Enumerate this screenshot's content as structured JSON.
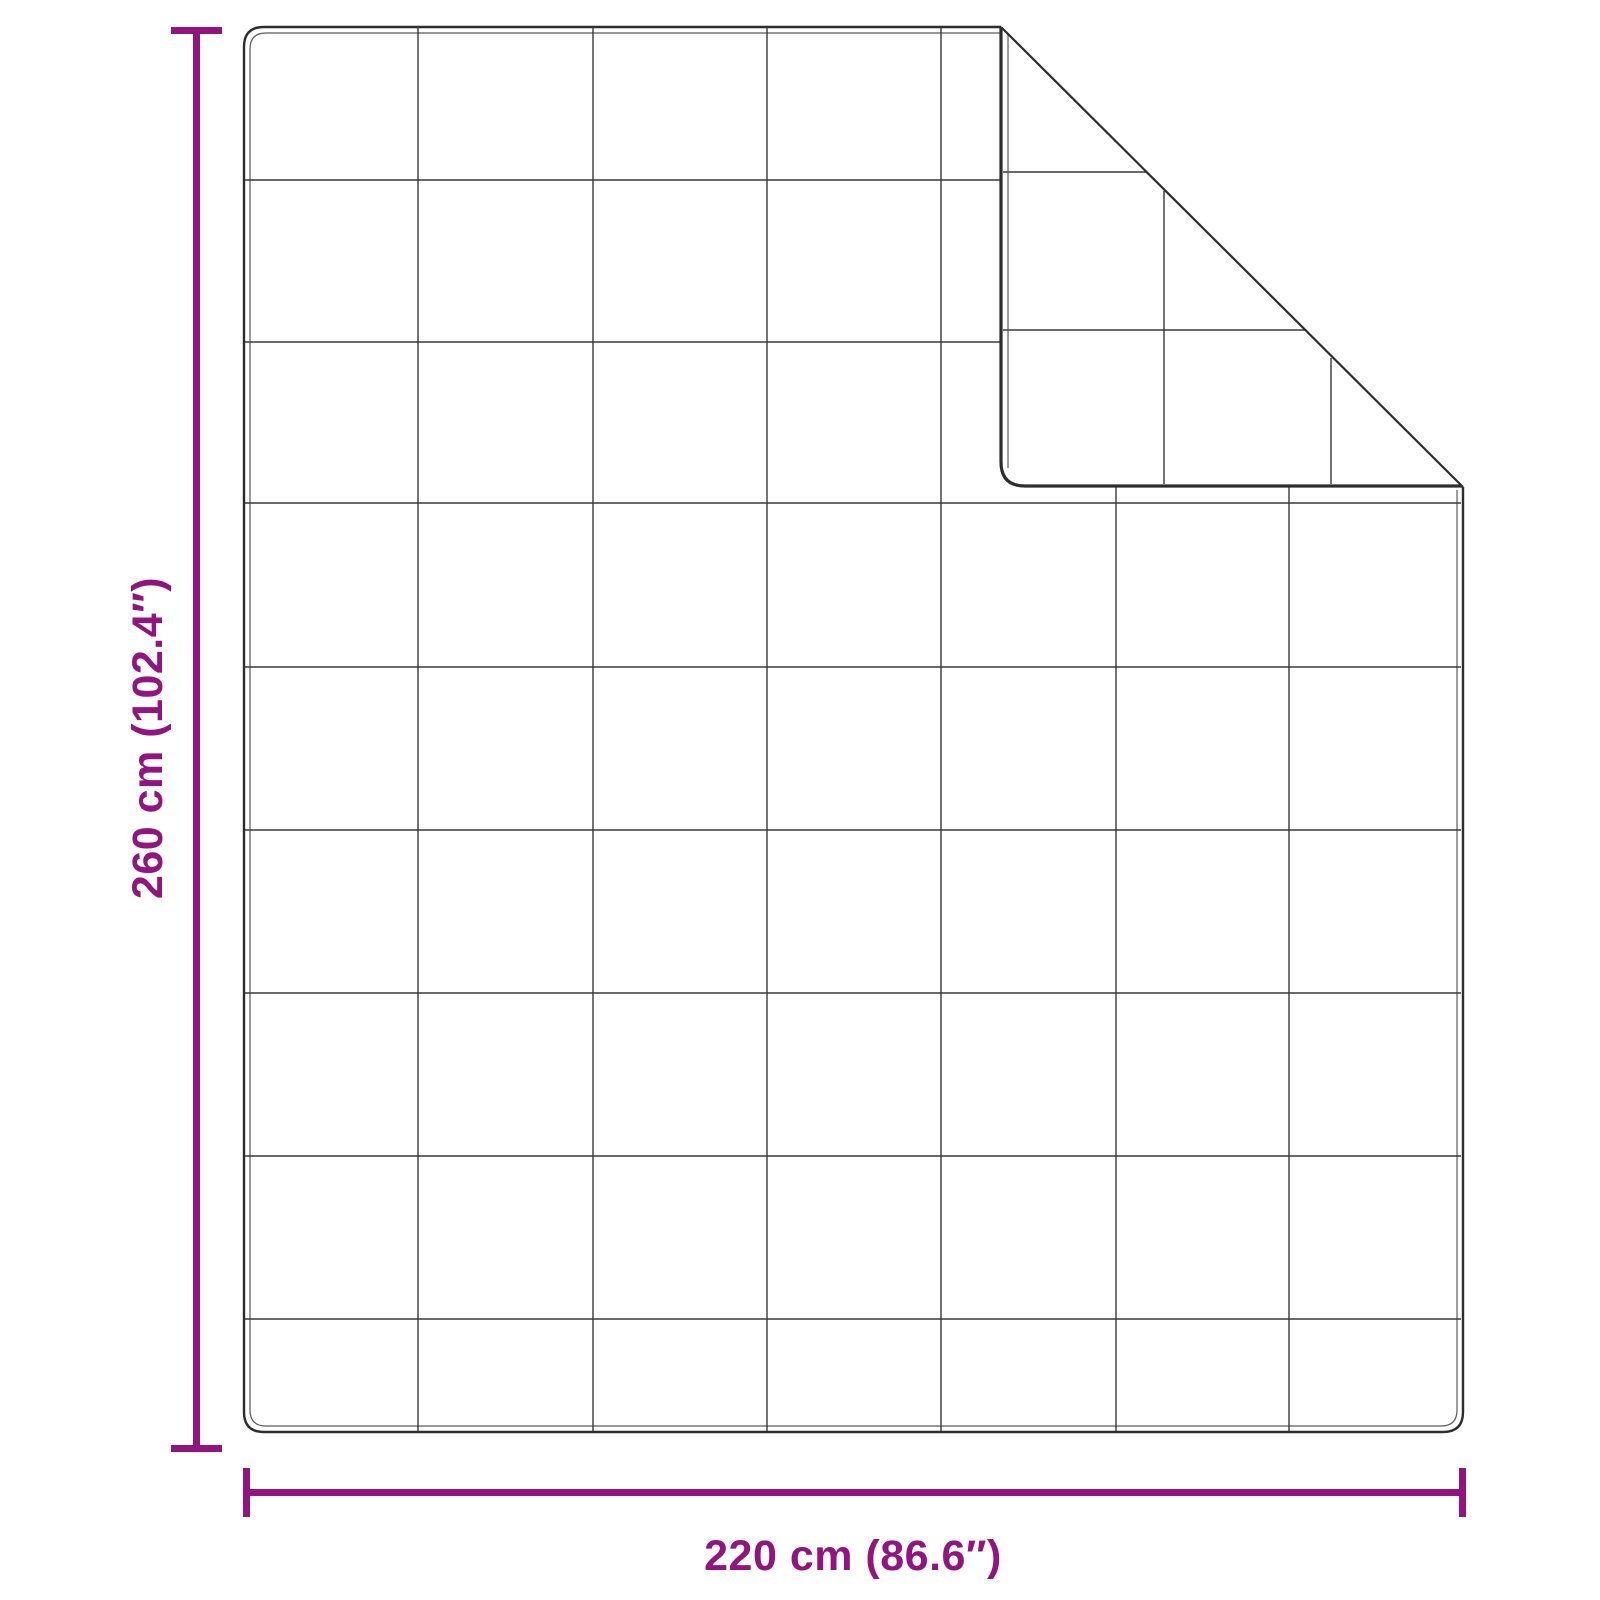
{
  "diagram": {
    "kind": "product-dimension-diagram",
    "subject": "quilted blanket with folded top-right corner"
  },
  "labels": {
    "height": "260 cm (102.4″)",
    "width": "220 cm (86.6″)"
  },
  "colors": {
    "dimension": "#92157F",
    "outline": "#2d2d2d",
    "seam": "#5a5a5a",
    "grid": "#383838",
    "background": "#ffffff"
  },
  "blanket": {
    "grid_columns": 7,
    "grid_rows": 9,
    "grid_lines": {
      "vertical": [
        {
          "x": 418,
          "y1": 27,
          "y2": 1431
        },
        {
          "x": 593,
          "y1": 27,
          "y2": 1431
        },
        {
          "x": 767,
          "y1": 27,
          "y2": 1431
        },
        {
          "x": 941,
          "y1": 27,
          "y2": 1431
        },
        {
          "x": 1116,
          "y1": 487,
          "y2": 1431
        },
        {
          "x": 1289,
          "y1": 487,
          "y2": 1431
        }
      ],
      "horizontal": [
        {
          "y": 180,
          "x1": 245,
          "x2": 1001
        },
        {
          "y": 342,
          "x1": 245,
          "x2": 1001
        },
        {
          "y": 503,
          "x1": 245,
          "x2": 1461
        },
        {
          "y": 667,
          "x1": 245,
          "x2": 1461
        },
        {
          "y": 830,
          "x1": 245,
          "x2": 1461
        },
        {
          "y": 993,
          "x1": 245,
          "x2": 1461
        },
        {
          "y": 1156,
          "x1": 245,
          "x2": 1461
        },
        {
          "y": 1319,
          "x1": 245,
          "x2": 1461
        }
      ],
      "flap_vertical": [
        {
          "x": 1164,
          "y1": 191,
          "y2": 484
        },
        {
          "x": 1331,
          "y1": 358,
          "y2": 484
        }
      ],
      "flap_horizontal": [
        {
          "y": 172,
          "x1": 1003,
          "x2": 1147
        },
        {
          "y": 330,
          "x1": 1003,
          "x2": 1305
        }
      ]
    }
  }
}
